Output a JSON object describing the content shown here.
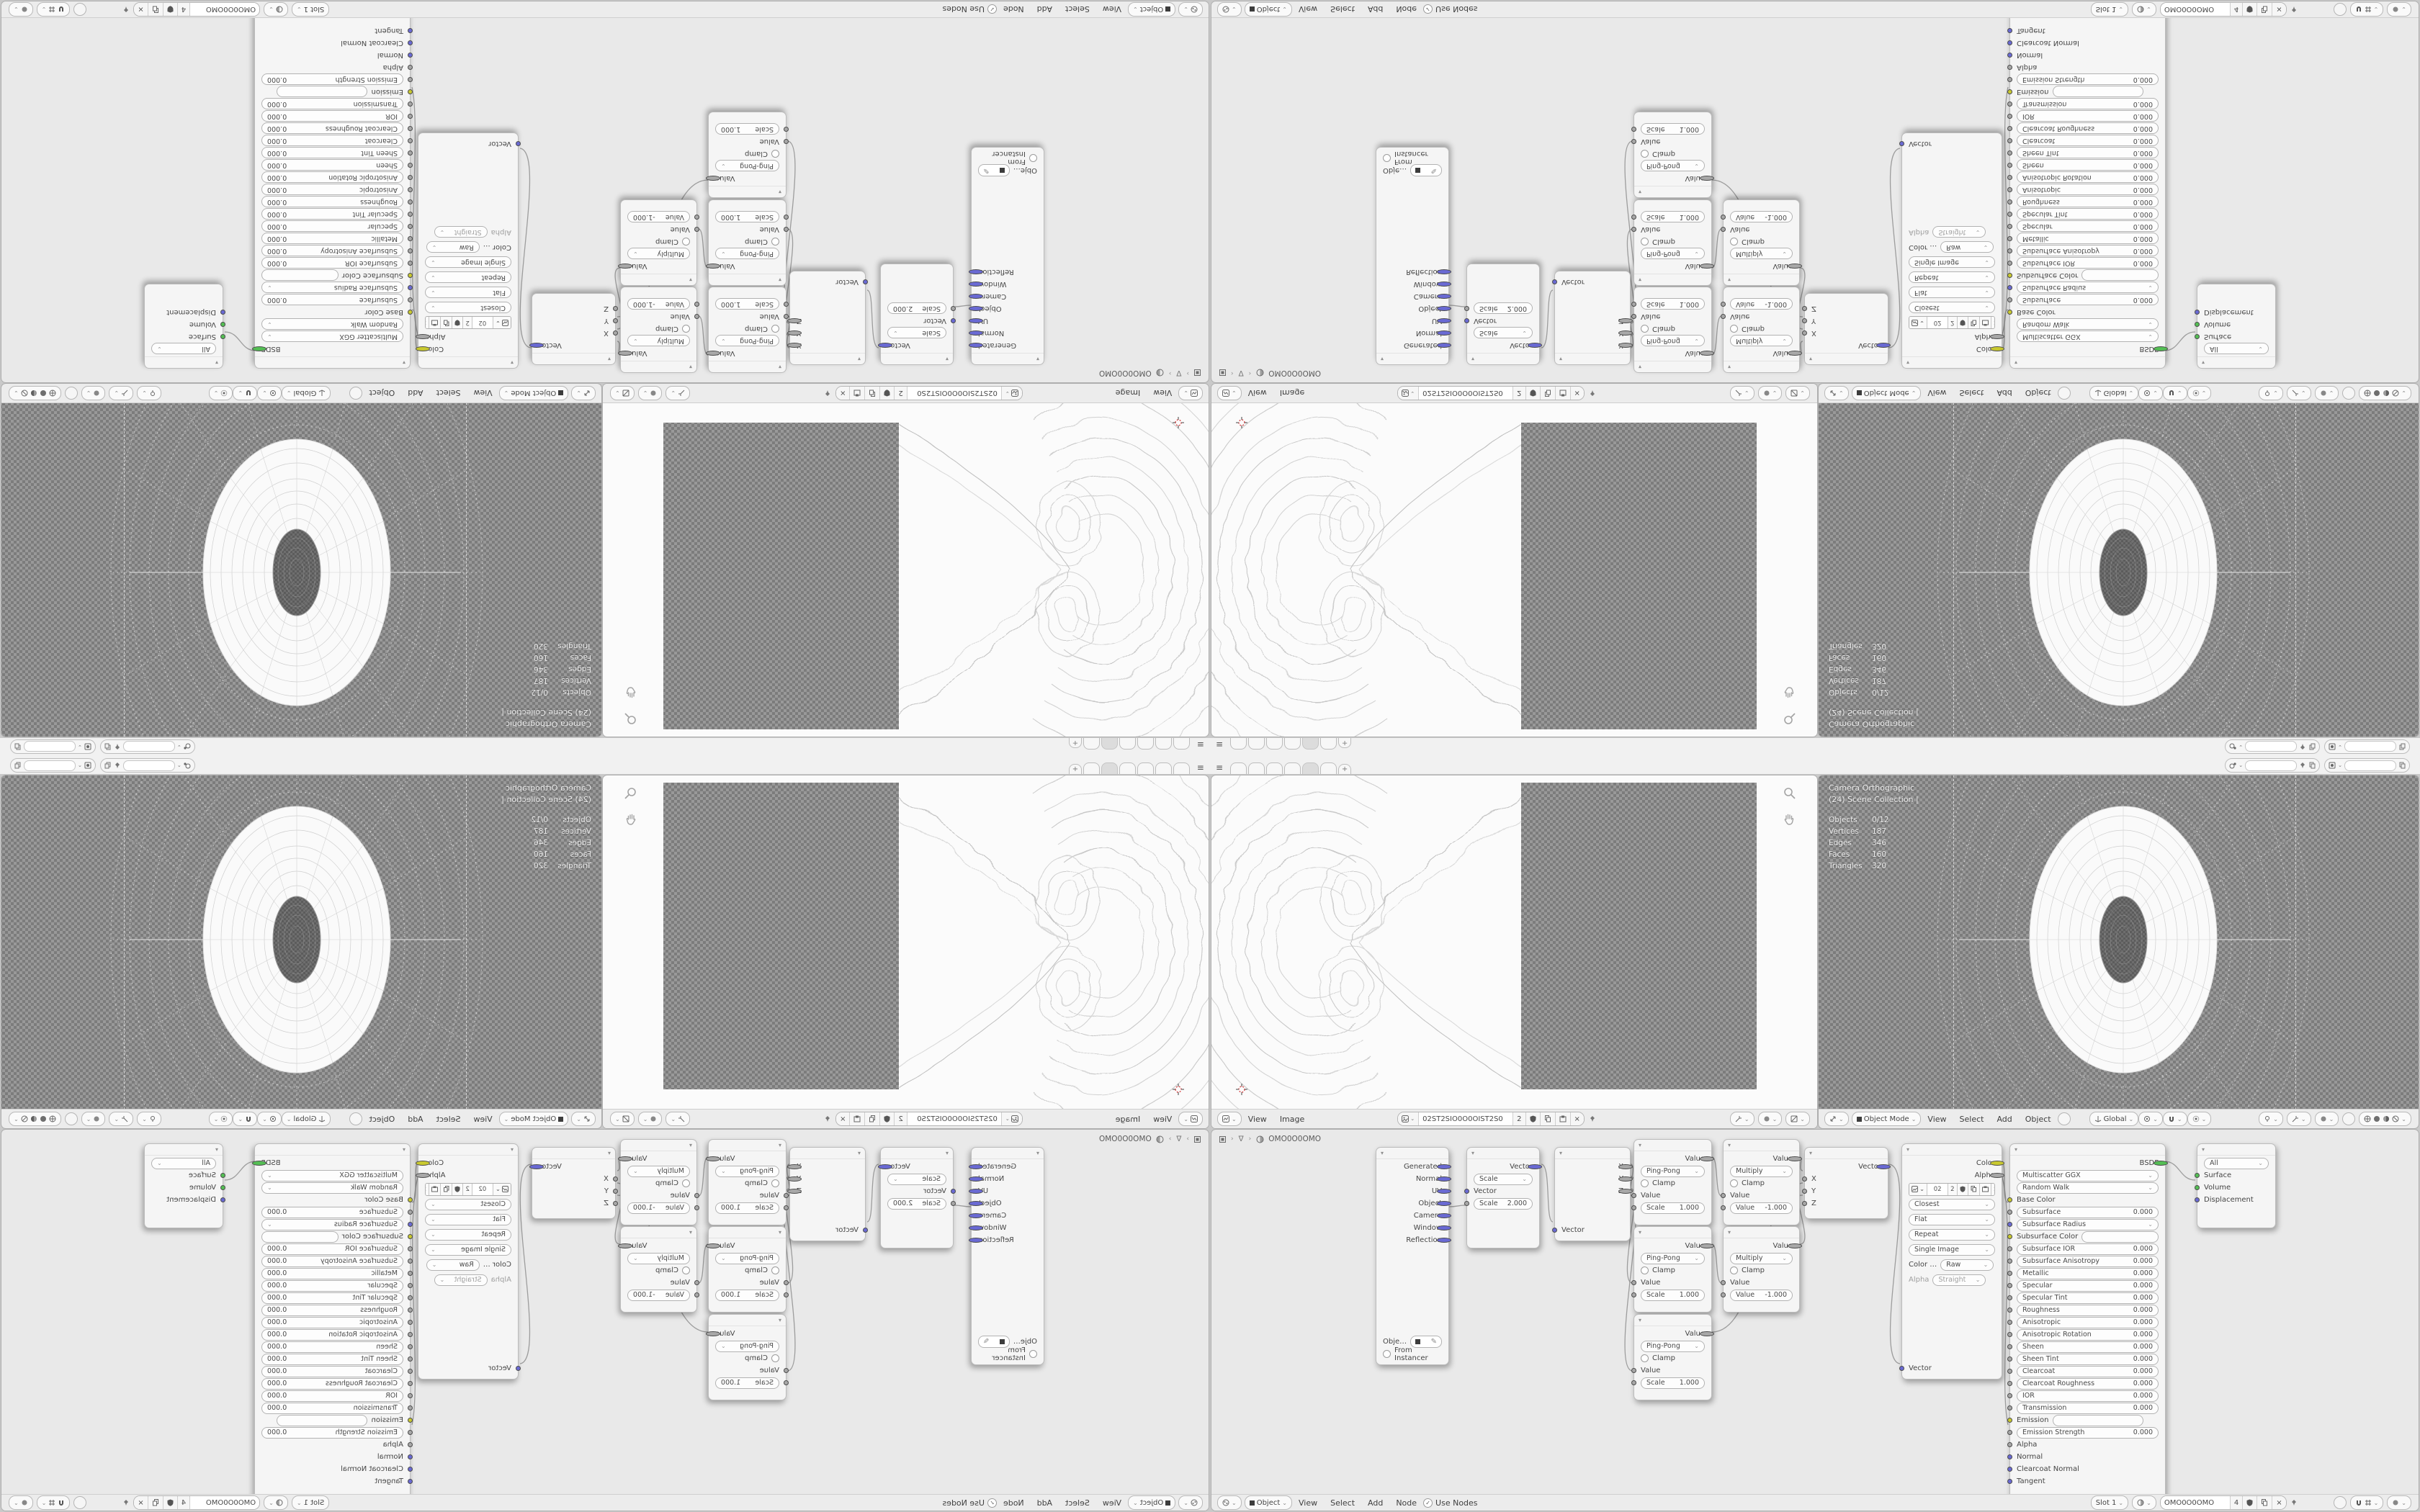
{
  "topbar": {
    "add_tab_label": "+"
  },
  "image_editor": {
    "menu_view": "View",
    "menu_image": "Image",
    "datablock_name": "02ST2SIO0O0OIST2S0",
    "datablock_users": "2"
  },
  "viewport": {
    "overlay_camera": "Camera Orthographic",
    "overlay_collection": "(24) Scene Collection |",
    "stats": [
      {
        "k": "Objects",
        "v": "0/12"
      },
      {
        "k": "Vertices",
        "v": "187"
      },
      {
        "k": "Edges",
        "v": "346"
      },
      {
        "k": "Faces",
        "v": "160"
      },
      {
        "k": "Triangles",
        "v": "320"
      }
    ],
    "header": {
      "mode": "Object Mode",
      "menu_view": "View",
      "menu_select": "Select",
      "menu_add": "Add",
      "menu_object": "Object",
      "orientation": "Global"
    }
  },
  "shader": {
    "breadcrumb_material": "OMO0O0OMO",
    "header": {
      "object": "Object",
      "menu_view": "View",
      "menu_select": "Select",
      "menu_add": "Add",
      "menu_node": "Node",
      "use_nodes": "Use Nodes",
      "slot": "Slot 1",
      "material_name": "OMO0O0OMO",
      "material_users": "4"
    },
    "nodes": {
      "tex_coord": {
        "outputs": [
          "Generated",
          "Normal",
          "UV",
          "Object",
          "Camera",
          "Window",
          "Reflection"
        ],
        "object_label": "Obje…",
        "from_instancer": "From Instancer"
      },
      "mapping": {
        "output": "Vector",
        "operation": "Scale",
        "input": "Vector",
        "scale_label": "Scale",
        "scale_value": "2.000"
      },
      "separate_xyz": {
        "out_x": "X",
        "out_y": "Y",
        "out_z": "Z",
        "input": "Vector"
      },
      "ping_pong": {
        "output": "Value",
        "operation": "Ping-Pong",
        "clamp": "Clamp",
        "input": "Value",
        "scale_label": "Scale",
        "scale_value": "1.000"
      },
      "multiply": {
        "output": "Value",
        "operation": "Multiply",
        "clamp": "Clamp",
        "input": "Value",
        "value_label": "Value",
        "value_value": "-1.000"
      },
      "combine_xyz": {
        "output": "Vector",
        "in_x": "X",
        "in_y": "Y",
        "in_z": "Z"
      },
      "image_texture": {
        "out_color": "Color",
        "out_alpha": "Alpha",
        "name": "02",
        "users": "2",
        "interpolation": "Closest",
        "projection": "Flat",
        "extension": "Repeat",
        "source": "Single Image",
        "colorspace_label": "Color …",
        "colorspace": "Raw",
        "alpha_label": "Alpha",
        "alpha_mode": "Straight",
        "input": "Vector"
      },
      "principled": {
        "output": "BSDF",
        "distribution": "Multiscatter GGX",
        "subsurface_method": "Random Walk",
        "base_color": "Base Color",
        "subsurface_label": "Subsurface",
        "subsurface_value": "0.000",
        "subsurface_radius": "Subsurface Radius",
        "subsurface_color": "Subsurface Color",
        "value_rows": [
          {
            "label": "Subsurface IOR",
            "value": "0.000"
          },
          {
            "label": "Subsurface Anisotropy",
            "value": "0.000"
          },
          {
            "label": "Metallic",
            "value": "0.000"
          },
          {
            "label": "Specular",
            "value": "0.000"
          },
          {
            "label": "Specular Tint",
            "value": "0.000"
          },
          {
            "label": "Roughness",
            "value": "0.000"
          },
          {
            "label": "Anisotropic",
            "value": "0.000"
          },
          {
            "label": "Anisotropic Rotation",
            "value": "0.000"
          },
          {
            "label": "Sheen",
            "value": "0.000"
          },
          {
            "label": "Sheen Tint",
            "value": "0.000"
          },
          {
            "label": "Clearcoat",
            "value": "0.000"
          },
          {
            "label": "Clearcoat Roughness",
            "value": "0.000"
          },
          {
            "label": "IOR",
            "value": "0.000"
          },
          {
            "label": "Transmission",
            "value": "0.000"
          }
        ],
        "emission": "Emission",
        "emission_strength_label": "Emission Strength",
        "emission_strength_value": "0.000",
        "alpha": "Alpha",
        "normal": "Normal",
        "clearcoat_normal": "Clearcoat Normal",
        "tangent": "Tangent"
      },
      "material_output": {
        "target": "All",
        "in_surface": "Surface",
        "in_volume": "Volume",
        "in_displacement": "Displacement"
      }
    }
  },
  "colors": {
    "socket_vector": "#6a6ad4",
    "socket_value": "#a8a8a8",
    "socket_color": "#c9c92f",
    "socket_shader": "#54bf54",
    "checker_dark": "#7c7c7c",
    "checker_light": "#999999",
    "cursor_red": "#d84a4a"
  }
}
